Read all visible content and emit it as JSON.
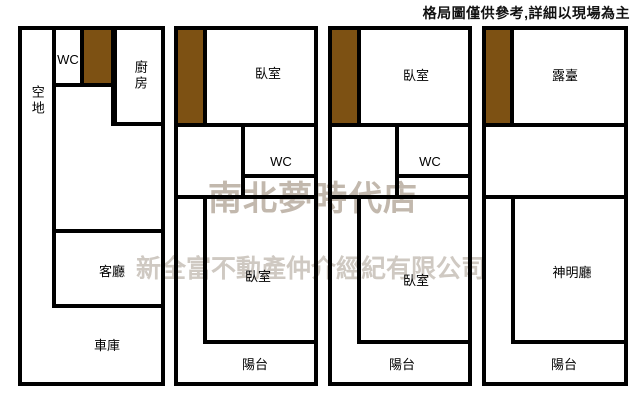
{
  "disclaimer": "格局圖僅供參考,詳細以現場為主",
  "watermark": {
    "line1": "南北夢時代店",
    "line2": "新全富不動產仲介經紀有限公司"
  },
  "colors": {
    "wall": "#000000",
    "stairs": "#7d5113",
    "watermark_line1": "#c2b8ad",
    "watermark_line2": "#cfc9c2"
  },
  "plans": [
    {
      "id": "floor-1",
      "rooms": {
        "vacant_lot": "空地",
        "wc": "WC",
        "kitchen": "廚房",
        "living_room": "客廳",
        "garage": "車庫"
      }
    },
    {
      "id": "floor-2",
      "rooms": {
        "bedroom_upper": "臥室",
        "wc": "WC",
        "bedroom_lower": "臥室",
        "balcony": "陽台"
      }
    },
    {
      "id": "floor-3",
      "rooms": {
        "bedroom_upper": "臥室",
        "wc": "WC",
        "bedroom_lower": "臥室",
        "balcony": "陽台"
      }
    },
    {
      "id": "floor-4",
      "rooms": {
        "terrace": "露臺",
        "shrine_hall": "神明廳",
        "balcony": "陽台"
      }
    }
  ]
}
